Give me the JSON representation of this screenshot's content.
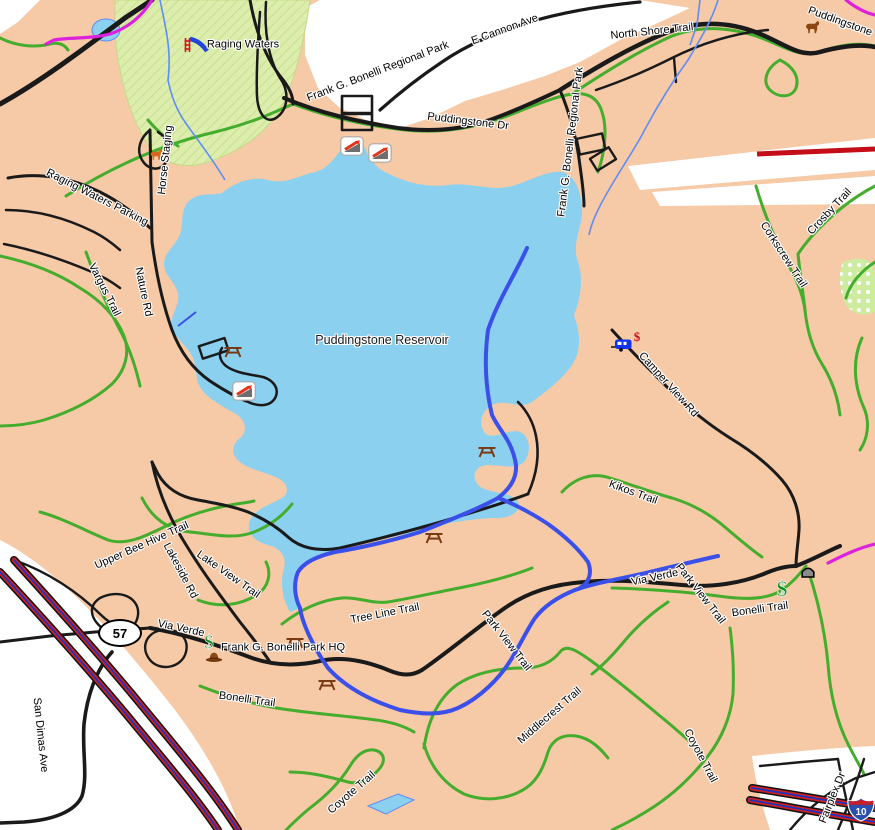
{
  "labels": {
    "raging_waters": {
      "text": "Raging Waters"
    },
    "e_cannon": {
      "text": "E Cannon Ave"
    },
    "north_shore": {
      "text": "North Shore Trail"
    },
    "puddingstone_ne": {
      "text": "Puddingstone"
    },
    "bonelli_park_nw": {
      "text": "Frank G. Bonelli Regional Park"
    },
    "puddingstone_dr": {
      "text": "Puddingstone Dr"
    },
    "bonelli_park_e": {
      "text": "Frank G. Bonelli Regional Park"
    },
    "horse_staging": {
      "text": "Horse Staging"
    },
    "rw_parking": {
      "text": "Raging Waters Parking"
    },
    "vargus": {
      "text": "Vargus Trail"
    },
    "nature_rd": {
      "text": "Nature Rd"
    },
    "reservoir": {
      "text": "Puddingstone Reservoir"
    },
    "crosby": {
      "text": "Crosby Trail"
    },
    "corkscrew": {
      "text": "Corkscrew Trail"
    },
    "camper_view": {
      "text": "Camper View Rd"
    },
    "kikos": {
      "text": "Kikos Trail"
    },
    "via_verde_e": {
      "text": "Via Verde"
    },
    "park_view_e": {
      "text": "Park View Trail"
    },
    "bonelli_trail_e": {
      "text": "Bonelli Trail"
    },
    "upper_bee": {
      "text": "Upper Bee Hive Trail"
    },
    "lakeside": {
      "text": "Lakeside Rd"
    },
    "lake_view": {
      "text": "Lake View Trail"
    },
    "via_verde_w": {
      "text": "Via Verde"
    },
    "park_hq": {
      "text": "Frank G. Bonelli Park HQ"
    },
    "tree_line": {
      "text": "Tree Line Trail"
    },
    "park_view_w": {
      "text": "Park View Trail"
    },
    "bonelli_trail_w": {
      "text": "Bonelli Trail"
    },
    "middlecrest": {
      "text": "Middlecrest Trail"
    },
    "coyote_w": {
      "text": "Coyote Trail"
    },
    "coyote_e": {
      "text": "Coyote Trail"
    },
    "san_dimas": {
      "text": "San Dimas Ave"
    },
    "fairplex": {
      "text": "Fairplex Dr"
    }
  },
  "shields": {
    "sr57": "57",
    "i10": "10"
  },
  "glyphs": {
    "dollar": "$"
  },
  "colors": {
    "land": "#f6c9a7",
    "water": "#8cd0f0",
    "park_green": "#dcedad",
    "trail_green": "#45ad2d",
    "road_black": "#1a1a1a",
    "highway_magenta": "#dd22dd",
    "freeway_red": "#cd2020",
    "freeway_blue": "#2233bb",
    "rail_red": "#c40d18",
    "paved_path_blue": "#3a50e8",
    "stream_blue": "#5f8df5"
  },
  "icons": [
    {
      "name": "waterslide"
    },
    {
      "name": "horse"
    },
    {
      "name": "horse-staging"
    },
    {
      "name": "boat-ramp"
    },
    {
      "name": "picnic-table"
    },
    {
      "name": "camper"
    },
    {
      "name": "fee-dollar"
    },
    {
      "name": "tunnel"
    },
    {
      "name": "ranger-hat-hq"
    }
  ]
}
